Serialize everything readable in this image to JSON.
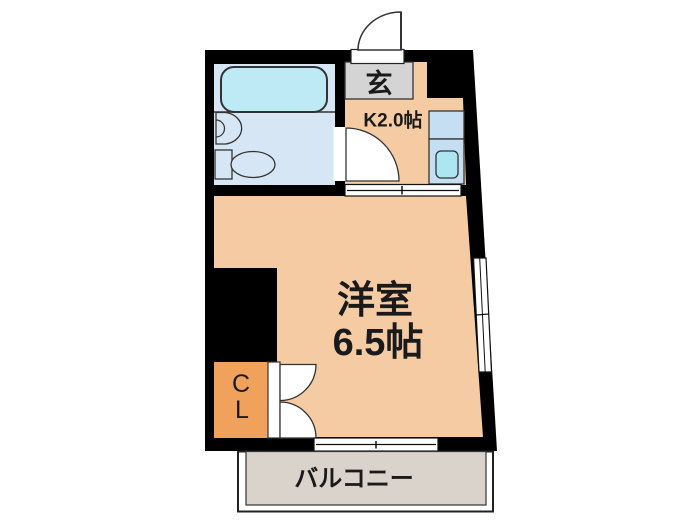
{
  "plan": {
    "entrance_label": "玄",
    "kitchen_label": "K2.0帖",
    "main_room_label_1": "洋室",
    "main_room_label_2": "6.5帖",
    "closet_label_1": "C",
    "closet_label_2": "L",
    "balcony_label": "バルコニー"
  },
  "colors": {
    "wall": "#000000",
    "room_peach": "#F5CBA4",
    "bathroom_blue": "#D7E6F4",
    "bathtub_cyan": "#BEEAF6",
    "counter_blue": "#C6DEF2",
    "sink_cyan": "#ACE6F0",
    "entrance_gray": "#D4D4D4",
    "closet_orange": "#F0A25C",
    "balcony_gray": "#D9D3CC",
    "line": "#1a1a1a"
  }
}
